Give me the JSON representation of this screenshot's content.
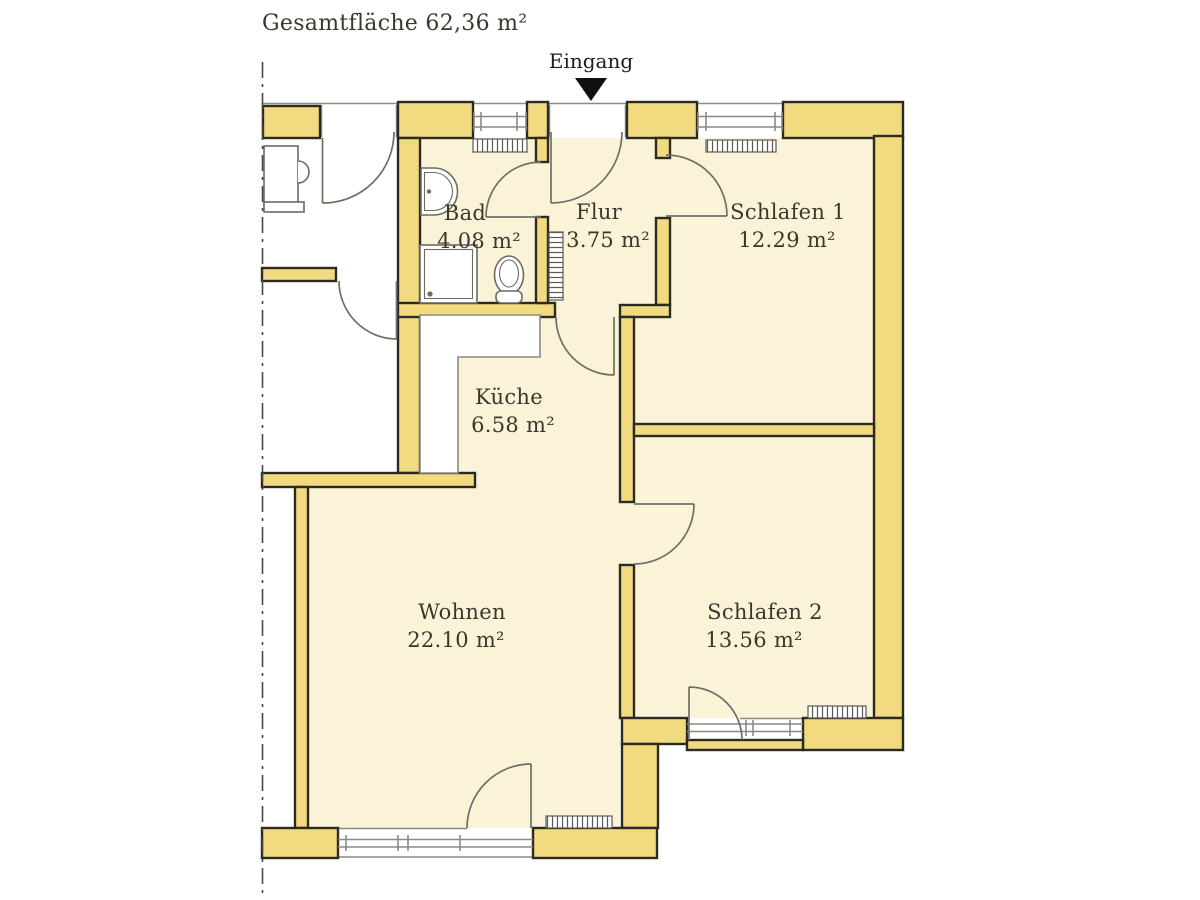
{
  "title": "Gesamtfläche 62,36 m²",
  "entrance": {
    "label": "Eingang"
  },
  "rooms": {
    "bad": {
      "name": "Bad",
      "area": "4.08 m²"
    },
    "flur": {
      "name": "Flur",
      "area": "3.75 m²"
    },
    "schlafen1": {
      "name": "Schlafen 1",
      "area": "12.29 m²"
    },
    "kueche": {
      "name": "Küche",
      "area": "6.58 m²"
    },
    "wohnen": {
      "name": "Wohnen",
      "area": "22.10 m²"
    },
    "schlafen2": {
      "name": "Schlafen 2",
      "area": "13.56 m²"
    }
  },
  "colors": {
    "room_fill": "#faf3d8",
    "wall_fill": "#f2da80",
    "outline": "#2b2b22",
    "line": "#8a8a84",
    "door": "#6f6f68",
    "text": "#3a382c",
    "arrow": "#101010"
  }
}
